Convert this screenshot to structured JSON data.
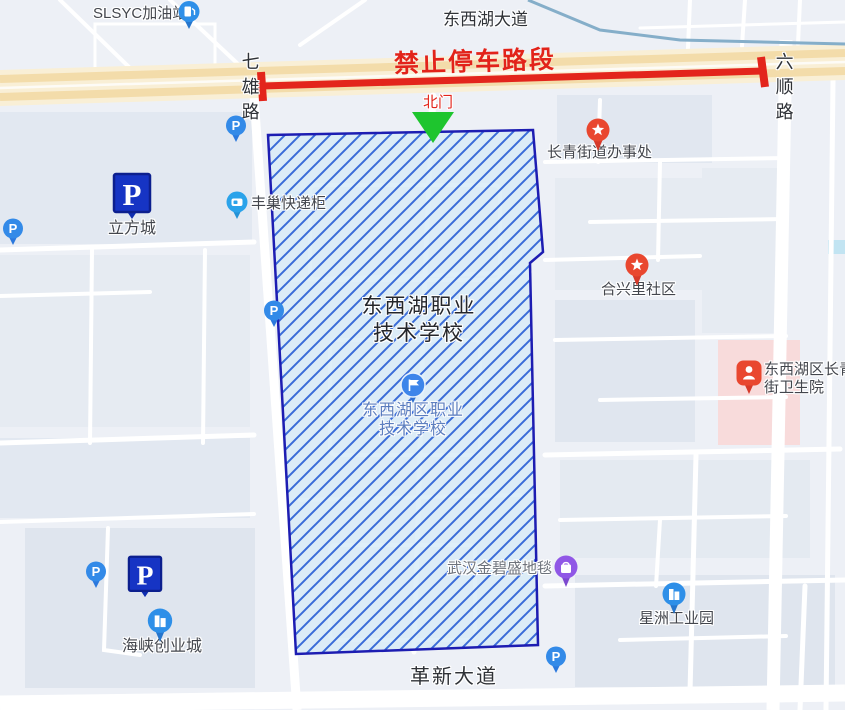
{
  "roads": {
    "top_avenue": "东西湖大道",
    "left_road": "七雄路",
    "right_road": "六顺路",
    "bottom_avenue": "革新大道"
  },
  "annotations": {
    "no_parking": "禁止停车路段",
    "north_gate": "北门"
  },
  "school": {
    "title_line1": "东西湖职业",
    "title_line2": "技术学校",
    "poi_line1": "东西湖区职业",
    "poi_line2": "技术学校"
  },
  "pois": {
    "gas_station": {
      "label": "SLSYC加油站"
    },
    "locker": {
      "label": "丰巢快递柜"
    },
    "lifangcheng": {
      "label": "立方城"
    },
    "street_office": {
      "label": "长青街道办事处"
    },
    "hexingli": {
      "label": "合兴里社区"
    },
    "hospital": {
      "line1": "东西湖区长青",
      "line2": "街卫生院"
    },
    "carpet": {
      "label": "武汉金碧盛地毯"
    },
    "xingzhou": {
      "label": "星洲工业园"
    },
    "haixia": {
      "label": "海峡创业城"
    }
  },
  "icons": {
    "parking_letter": "P"
  },
  "colors": {
    "no_parking_red": "#e2231a",
    "gate_green": "#1ec52e",
    "boundary_blue": "#1d1db2",
    "hatch_blue": "#3a6cd8",
    "hatch_fill": "#d8ebf8",
    "parking_navy": "#1634c4",
    "poi_blue": "#2e8fe8",
    "pin_red": "#e9472f",
    "bag_purple": "#9057e6",
    "highway_beige": "#f9efd6",
    "railway_blue": "#85aec9",
    "hospital_pink": "#f8dbdb"
  }
}
